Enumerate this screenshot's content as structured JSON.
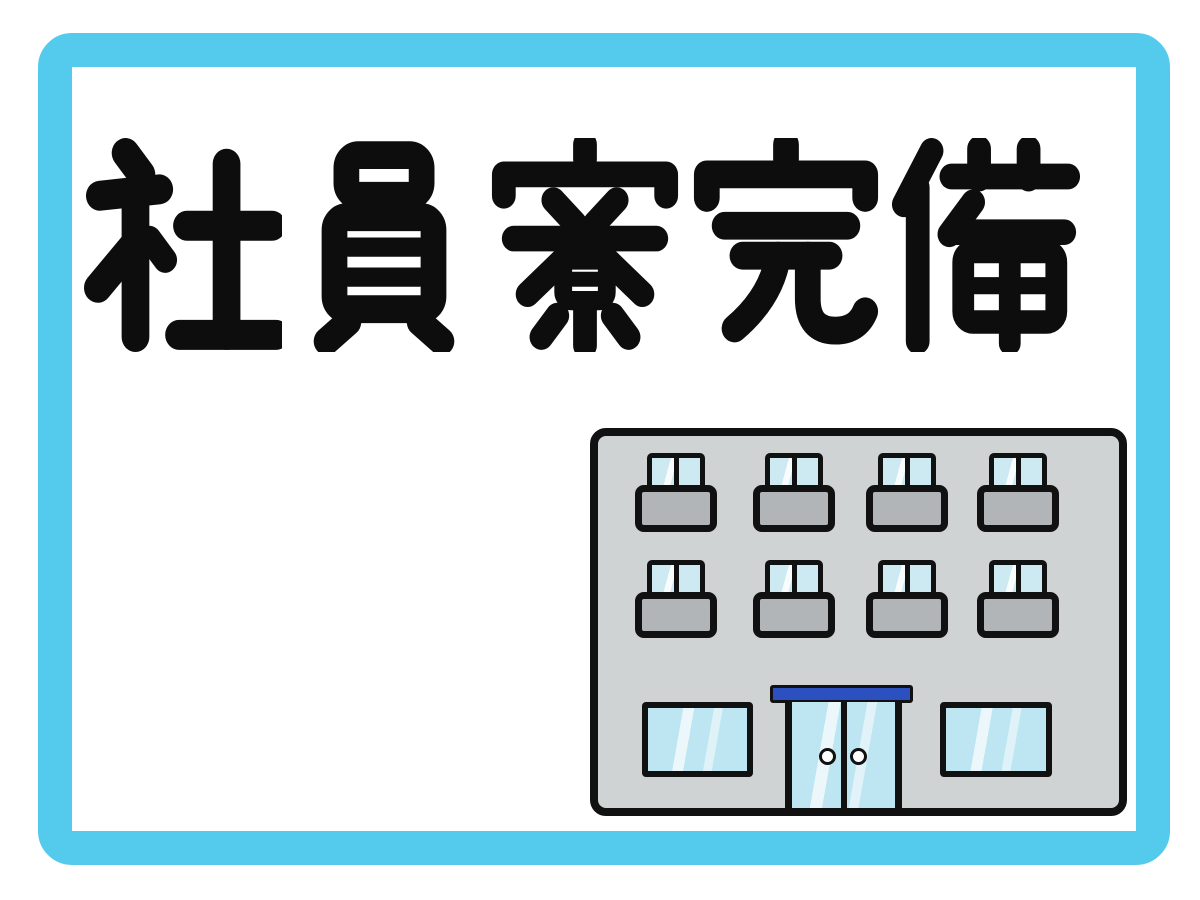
{
  "headline": {
    "text": "社員寮完備",
    "chars": [
      "社",
      "員",
      "寮",
      "完",
      "備"
    ]
  },
  "illustration": {
    "name": "dormitory-building",
    "upper_floor_rows": 2,
    "window_units_per_row": 4,
    "ground_floor_windows": 2,
    "entrance": "double-sliding-glass-door",
    "door_handles": 2,
    "awning": true
  },
  "colors": {
    "frame": "#54cbec",
    "ink": "#0d0d0d",
    "canvas": "#ffffff",
    "outline": "#111111",
    "building": "#cfd3d4",
    "balcony": "#b2b5b8",
    "glass": "#cde9f2",
    "glassGround": "#bde5f2",
    "awning": "#2c50c0",
    "handle": "#ffffff"
  }
}
